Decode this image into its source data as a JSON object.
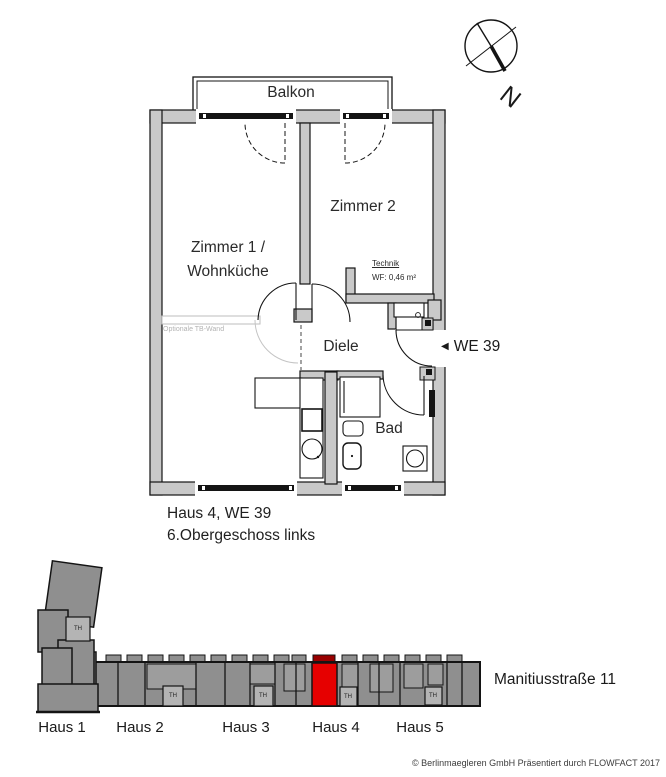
{
  "compass": {
    "north_label": "N"
  },
  "floor_plan": {
    "balcony_label": "Balkon",
    "room1_line1": "Zimmer 1 /",
    "room1_line2": "Wohnküche",
    "room2_label": "Zimmer 2",
    "hall_label": "Diele",
    "bath_label": "Bad",
    "technik_label": "Technik",
    "technik_area": "WF: 0,46 m²",
    "optional_wall_label": "Optionale TB-Wand",
    "pointer": {
      "arrow": "◀",
      "label": "WE 39"
    },
    "caption_line1": "Haus 4, WE 39",
    "caption_line2": "6.Obergeschoss links",
    "wall_color": "#c9c9c9"
  },
  "site_plan": {
    "street_label": "Manitiusstraße 11",
    "stairwell_label": "TH",
    "houses": [
      {
        "label": "Haus 1"
      },
      {
        "label": "Haus 2"
      },
      {
        "label": "Haus 3"
      },
      {
        "label": "Haus 4"
      },
      {
        "label": "Haus 5"
      }
    ],
    "building_color": "#8f8f8f",
    "stairwell_box_color": "#b4b4b4",
    "highlight_color": "#e60000",
    "highlight_dark": "#990000"
  },
  "footer": {
    "copyright": "© Berlinmaegleren GmbH Präsentiert durch FLOWFACT 2017"
  }
}
